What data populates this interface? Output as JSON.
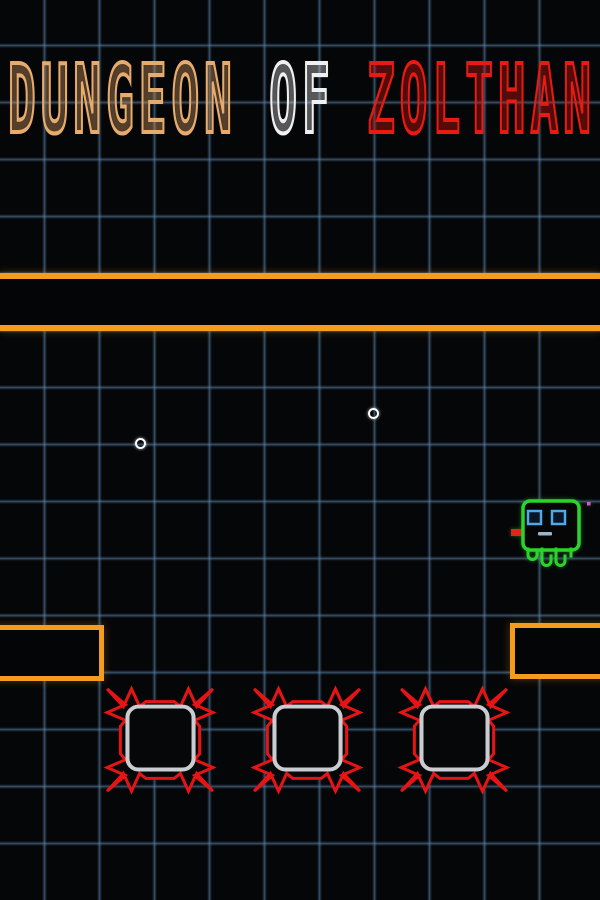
{
  "title": {
    "word1": "DUNGEON",
    "word2": "OF",
    "word3": "ZOLTHAN"
  },
  "colors": {
    "background": "#050608",
    "grid_line": "#3c5a78",
    "platform_orange": "#f59b1e",
    "title_dungeon": "#e8ab6e",
    "title_of": "#f0f0f0",
    "title_zolthan": "#e81a12",
    "hazard_red": "#e61414",
    "hazard_inner_gray": "#c9ccd0",
    "player_green": "#2bd42b",
    "player_eye_blue": "#4fa8e8",
    "player_mouth": "#9fb6c8",
    "player_tongue_red": "#e5231a",
    "pickup_white": "#ffffff"
  },
  "scene": {
    "walls": {
      "full_width_band": "double orange horizontal wall",
      "left_ledge": "orange platform at left edge",
      "right_ledge": "orange platform at right edge"
    },
    "pickups": {
      "count": 2,
      "style": "small white ring"
    },
    "hazards": {
      "count": 3,
      "style": "red spiked mine with gray rounded-square core"
    },
    "player": {
      "style": "green square creature with blue eyes, red tongue and tentacle legs"
    }
  }
}
